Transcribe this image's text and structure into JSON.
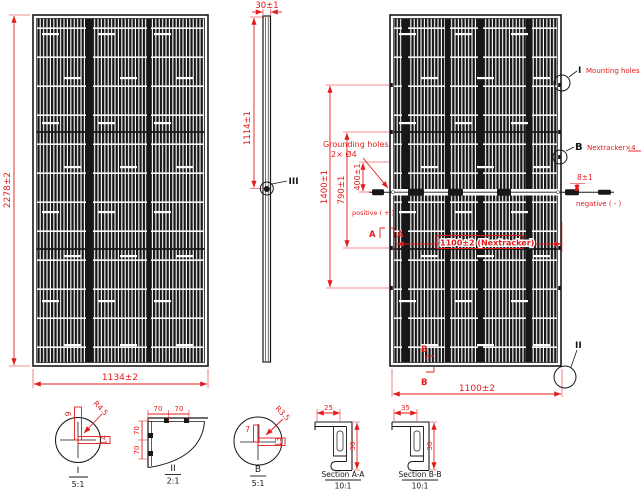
{
  "drawing": {
    "front_view": {
      "height": "2278±2",
      "width": "1134±2"
    },
    "side_view": {
      "thickness": "30±1",
      "mount_offset": "1114±1",
      "detail_ref": "III"
    },
    "back_view": {
      "mount_span": "1400±1",
      "inner_span": "790±1",
      "jbox_offset": "400±1",
      "edge_offset": "8±1",
      "width": "1100±2",
      "tracker_span": "1100±2  (Nextracker)",
      "grounding_title": "Grounding holes",
      "grounding_spec": "2× Ø4",
      "positive": "positive ( + )",
      "negative": "negative ( - )",
      "callout_i_ref": "I",
      "callout_i_label": "Mounting holes×8",
      "callout_b_ref": "B",
      "callout_b_label": "Nextracker×4",
      "callout_ii_ref": "II",
      "section_a": "A",
      "section_b": "B"
    },
    "details": {
      "detail_i": {
        "ref": "I",
        "scale": "5:1",
        "dim_width": "9",
        "dim_radius": "R4.5",
        "dim_length": "14"
      },
      "detail_ii": {
        "ref": "II",
        "scale": "2:1",
        "dim_top1": "70",
        "dim_top2": "70",
        "dim_left1": "70",
        "dim_left2": "70"
      },
      "detail_b": {
        "ref": "B",
        "scale": "5:1",
        "dim_width": "7",
        "dim_radius": "R3.5",
        "dim_length": "13"
      },
      "section_aa": {
        "title": "Section A-A",
        "scale": "10:1",
        "dim_width": "25",
        "dim_height": "30"
      },
      "section_bb": {
        "title": "Section B-B",
        "scale": "10:1",
        "dim_width": "35",
        "dim_height": "30"
      }
    },
    "colors": {
      "dimension": "#e31b1b",
      "line": "#181818"
    }
  }
}
